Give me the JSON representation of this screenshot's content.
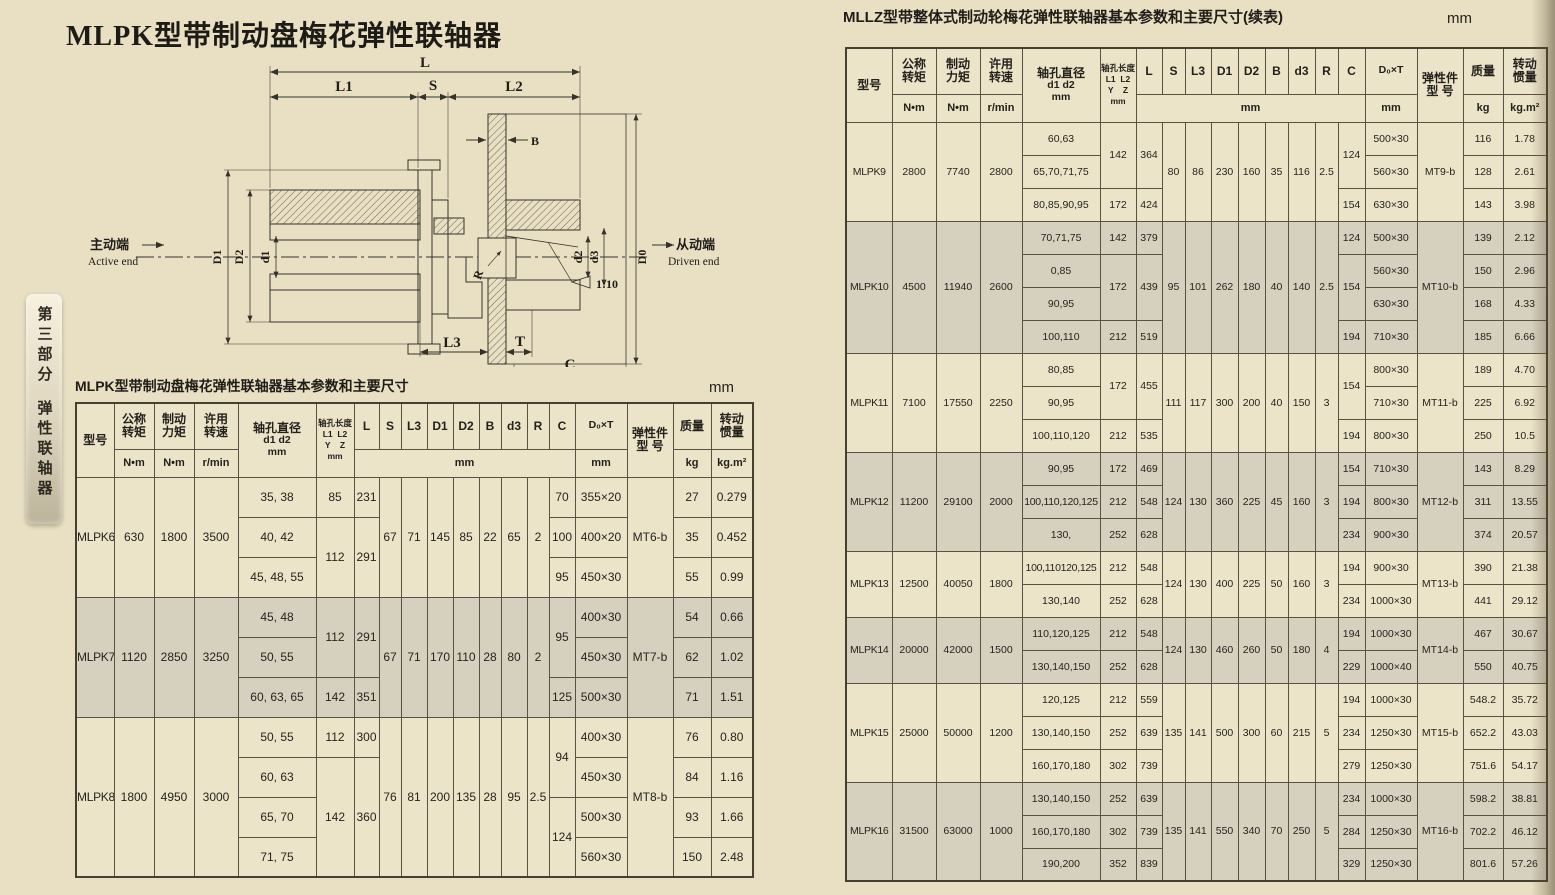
{
  "left": {
    "title": "MLPK型带制动盘梅花弹性联轴器",
    "caption": "MLPK型带制动盘梅花弹性联轴器基本参数和主要尺寸",
    "unit": "mm"
  },
  "right": {
    "caption": "MLLZ型带整体式制动轮梅花弹性联轴器基本参数和主要尺寸(续表)",
    "unit": "mm"
  },
  "side_tab": {
    "part": "第三部分",
    "section": "弹性联轴器"
  },
  "diagram": {
    "l": "L",
    "l1": "L1",
    "s": "S",
    "l2": "L2",
    "b": "B",
    "r": "R",
    "taper": "1:10",
    "big_d1": "D1",
    "big_d2": "D2",
    "small_d1": "d1",
    "small_d2": "d2",
    "small_d3": "d3",
    "d0": "D0",
    "l3": "L3",
    "t": "T",
    "c": "C",
    "active_cn": "主动端",
    "active_en": "Active end",
    "driven_cn": "从动端",
    "driven_en": "Driven end"
  },
  "header": {
    "model": "型号",
    "torque": [
      "公称",
      "转矩"
    ],
    "brake": [
      "制动",
      "力矩"
    ],
    "speed": [
      "许用",
      "转速"
    ],
    "nm": "N•m",
    "rpm": "r/min",
    "bore_dia": [
      "轴孔直径",
      "d1 d2",
      "mm"
    ],
    "bore_len": [
      "轴孔长度",
      "L1  L2",
      "Y    Z",
      "mm"
    ],
    "dims": [
      "L",
      "S",
      "L3",
      "D1",
      "D2",
      "B",
      "d3",
      "R",
      "C"
    ],
    "mm": "mm",
    "d0t": "D₀×T",
    "elastic": [
      "弹性件",
      "型  号"
    ],
    "mass": "质量",
    "kg": "kg",
    "inertia": [
      "转动",
      "惯量"
    ],
    "kgm2": "kg.m²"
  },
  "left_table": {
    "blocks": [
      {
        "model": "MLPK6",
        "tq": "630",
        "bk": "1800",
        "sp": "3500",
        "sh": false,
        "dims": [
          "67",
          "71",
          "145",
          "85",
          "22",
          "65",
          "2"
        ],
        "el": "MT6-b",
        "rows": [
          {
            "b": "35, 38",
            "yl": [
              "85",
              "231",
              1
            ],
            "c": [
              "70",
              1
            ],
            "dt": "355×20",
            "m": "27",
            "j": "0.279"
          },
          {
            "b": "40, 42",
            "yl": [
              "112",
              "291",
              2
            ],
            "c": [
              "100",
              1
            ],
            "dt": "400×20",
            "m": "35",
            "j": "0.452"
          },
          {
            "b": "45, 48, 55",
            "yl": null,
            "c": [
              "95",
              1
            ],
            "dt": "450×30",
            "m": "55",
            "j": "0.99"
          }
        ]
      },
      {
        "model": "MLPK7",
        "tq": "1120",
        "bk": "2850",
        "sp": "3250",
        "sh": true,
        "dims": [
          "67",
          "71",
          "170",
          "110",
          "28",
          "80",
          "2"
        ],
        "el": "MT7-b",
        "rows": [
          {
            "b": "45, 48",
            "yl": [
              "112",
              "291",
              2
            ],
            "c": [
              "95",
              2
            ],
            "dt": "400×30",
            "m": "54",
            "j": "0.66"
          },
          {
            "b": "50, 55",
            "yl": null,
            "c": null,
            "dt": "450×30",
            "m": "62",
            "j": "1.02"
          },
          {
            "b": "60, 63, 65",
            "yl": [
              "142",
              "351",
              1
            ],
            "c": [
              "125",
              1
            ],
            "dt": "500×30",
            "m": "71",
            "j": "1.51"
          }
        ]
      },
      {
        "model": "MLPK8",
        "tq": "1800",
        "bk": "4950",
        "sp": "3000",
        "sh": false,
        "dims": [
          "76",
          "81",
          "200",
          "135",
          "28",
          "95",
          "2.5"
        ],
        "el": "MT8-b",
        "rows": [
          {
            "b": "50, 55",
            "yl": [
              "112",
              "300",
              1
            ],
            "c": [
              "94",
              2
            ],
            "dt": "400×30",
            "m": "76",
            "j": "0.80"
          },
          {
            "b": "60, 63",
            "yl": [
              "142",
              "360",
              3
            ],
            "c": null,
            "dt": "450×30",
            "m": "84",
            "j": "1.16"
          },
          {
            "b": "65, 70",
            "yl": null,
            "c": [
              "124",
              2
            ],
            "dt": "500×30",
            "m": "93",
            "j": "1.66"
          },
          {
            "b": "71, 75",
            "yl": null,
            "c": null,
            "dt": "560×30",
            "m": "150",
            "j": "2.48"
          }
        ]
      }
    ]
  },
  "right_table": {
    "blocks": [
      {
        "model": "MLPK9",
        "tq": "2800",
        "bk": "7740",
        "sp": "2800",
        "sh": false,
        "dims": [
          "80",
          "86",
          "230",
          "160",
          "35",
          "116",
          "2.5"
        ],
        "el": "MT9-b",
        "rows": [
          {
            "b": "60,63",
            "yl": [
              "142",
              "364",
              2
            ],
            "c": [
              "124",
              2
            ],
            "dt": "500×30",
            "m": "116",
            "j": "1.78"
          },
          {
            "b": "65,70,71,75",
            "yl": null,
            "c": null,
            "dt": "560×30",
            "m": "128",
            "j": "2.61"
          },
          {
            "b": "80,85,90,95",
            "yl": [
              "172",
              "424",
              1
            ],
            "c": [
              "154",
              1
            ],
            "dt": "630×30",
            "m": "143",
            "j": "3.98"
          }
        ]
      },
      {
        "model": "MLPK10",
        "tq": "4500",
        "bk": "11940",
        "sp": "2600",
        "sh": true,
        "dims": [
          "95",
          "101",
          "262",
          "180",
          "40",
          "140",
          "2.5"
        ],
        "el": "MT10-b",
        "rows": [
          {
            "b": "70,71,75",
            "yl": [
              "142",
              "379",
              1
            ],
            "c": [
              "124",
              1
            ],
            "dt": "500×30",
            "m": "139",
            "j": "2.12"
          },
          {
            "b": "0,85",
            "yl": [
              "172",
              "439",
              2
            ],
            "c": [
              "154",
              2
            ],
            "dt": "560×30",
            "m": "150",
            "j": "2.96"
          },
          {
            "b": "90,95",
            "yl": null,
            "c": null,
            "dt": "630×30",
            "m": "168",
            "j": "4.33"
          },
          {
            "b": "100,110",
            "yl": [
              "212",
              "519",
              1
            ],
            "c": [
              "194",
              1
            ],
            "dt": "710×30",
            "m": "185",
            "j": "6.66"
          }
        ]
      },
      {
        "model": "MLPK11",
        "tq": "7100",
        "bk": "17550",
        "sp": "2250",
        "sh": false,
        "dims": [
          "111",
          "117",
          "300",
          "200",
          "40",
          "150",
          "3"
        ],
        "el": "MT11-b",
        "rows": [
          {
            "b": "80,85",
            "yl": [
              "172",
              "455",
              2
            ],
            "c": [
              "154",
              2
            ],
            "dt": "800×30",
            "m": "189",
            "j": "4.70"
          },
          {
            "b": "90,95",
            "yl": null,
            "c": null,
            "dt": "710×30",
            "m": "225",
            "j": "6.92"
          },
          {
            "b": "100,110,120",
            "yl": [
              "212",
              "535",
              1
            ],
            "c": [
              "194",
              1
            ],
            "dt": "800×30",
            "m": "250",
            "j": "10.5"
          }
        ]
      },
      {
        "model": "MLPK12",
        "tq": "11200",
        "bk": "29100",
        "sp": "2000",
        "sh": true,
        "dims": [
          "124",
          "130",
          "360",
          "225",
          "45",
          "160",
          "3"
        ],
        "el": "MT12-b",
        "rows": [
          {
            "b": "90,95",
            "yl": [
              "172",
              "469",
              1
            ],
            "c": [
              "154",
              1
            ],
            "dt": "710×30",
            "m": "143",
            "j": "8.29"
          },
          {
            "b": "100,110,120,125",
            "yl": [
              "212",
              "548",
              1
            ],
            "c": [
              "194",
              1
            ],
            "dt": "800×30",
            "m": "311",
            "j": "13.55"
          },
          {
            "b": "130,",
            "yl": [
              "252",
              "628",
              1
            ],
            "c": [
              "234",
              1
            ],
            "dt": "900×30",
            "m": "374",
            "j": "20.57"
          }
        ]
      },
      {
        "model": "MLPK13",
        "tq": "12500",
        "bk": "40050",
        "sp": "1800",
        "sh": false,
        "dims": [
          "124",
          "130",
          "400",
          "225",
          "50",
          "160",
          "3"
        ],
        "el": "MT13-b",
        "rows": [
          {
            "b": "100,110120,125",
            "yl": [
              "212",
              "548",
              1
            ],
            "c": [
              "194",
              1
            ],
            "dt": "900×30",
            "m": "390",
            "j": "21.38"
          },
          {
            "b": "130,140",
            "yl": [
              "252",
              "628",
              1
            ],
            "c": [
              "234",
              1
            ],
            "dt": "1000×30",
            "m": "441",
            "j": "29.12"
          }
        ]
      },
      {
        "model": "MLPK14",
        "tq": "20000",
        "bk": "42000",
        "sp": "1500",
        "sh": true,
        "dims": [
          "124",
          "130",
          "460",
          "260",
          "50",
          "180",
          "4"
        ],
        "el": "MT14-b",
        "rows": [
          {
            "b": "110,120,125",
            "yl": [
              "212",
              "548",
              1
            ],
            "c": [
              "194",
              1
            ],
            "dt": "1000×30",
            "m": "467",
            "j": "30.67"
          },
          {
            "b": "130,140,150",
            "yl": [
              "252",
              "628",
              1
            ],
            "c": [
              "229",
              1
            ],
            "dt": "1000×40",
            "m": "550",
            "j": "40.75"
          }
        ]
      },
      {
        "model": "MLPK15",
        "tq": "25000",
        "bk": "50000",
        "sp": "1200",
        "sh": false,
        "dims": [
          "135",
          "141",
          "500",
          "300",
          "60",
          "215",
          "5"
        ],
        "el": "MT15-b",
        "rows": [
          {
            "b": "120,125",
            "yl": [
              "212",
              "559",
              1
            ],
            "c": [
              "194",
              1
            ],
            "dt": "1000×30",
            "m": "548.2",
            "j": "35.72"
          },
          {
            "b": "130,140,150",
            "yl": [
              "252",
              "639",
              1
            ],
            "c": [
              "234",
              1
            ],
            "dt": "1250×30",
            "m": "652.2",
            "j": "43.03"
          },
          {
            "b": "160,170,180",
            "yl": [
              "302",
              "739",
              1
            ],
            "c": [
              "279",
              1
            ],
            "dt": "1250×30",
            "m": "751.6",
            "j": "54.17"
          }
        ]
      },
      {
        "model": "MLPK16",
        "tq": "31500",
        "bk": "63000",
        "sp": "1000",
        "sh": true,
        "dims": [
          "135",
          "141",
          "550",
          "340",
          "70",
          "250",
          "5"
        ],
        "el": "MT16-b",
        "rows": [
          {
            "b": "130,140,150",
            "yl": [
              "252",
              "639",
              1
            ],
            "c": [
              "234",
              1
            ],
            "dt": "1000×30",
            "m": "598.2",
            "j": "38.81"
          },
          {
            "b": "160,170,180",
            "yl": [
              "302",
              "739",
              1
            ],
            "c": [
              "284",
              1
            ],
            "dt": "1250×30",
            "m": "702.2",
            "j": "46.12"
          },
          {
            "b": "190,200",
            "yl": [
              "352",
              "839",
              1
            ],
            "c": [
              "329",
              1
            ],
            "dt": "1250×30",
            "m": "801.6",
            "j": "57.26"
          }
        ]
      }
    ]
  },
  "colors": {
    "page_bg": "#e9e0c4",
    "cell_bg": "#ece4c9",
    "shaded_bg": "#d6d0bf",
    "line": "#5a5240"
  }
}
